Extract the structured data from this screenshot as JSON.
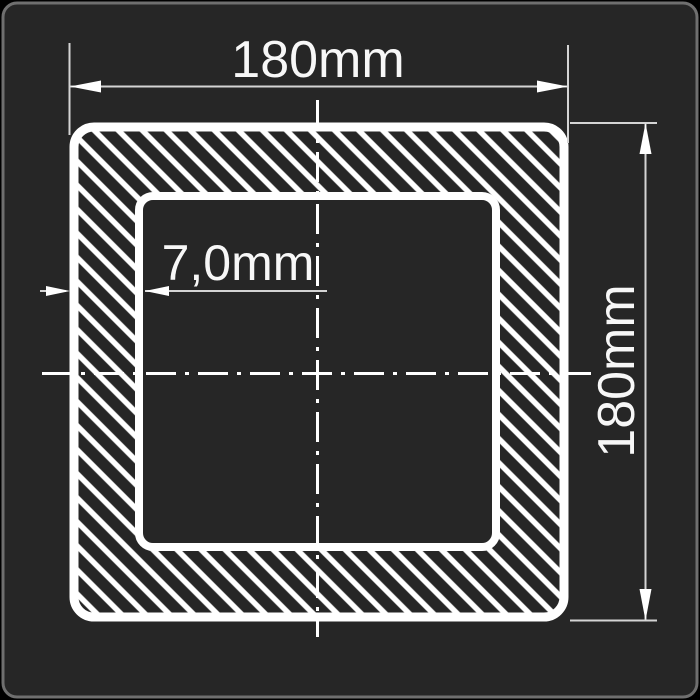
{
  "diagram": {
    "kind": "square-hollow-section-cross-section",
    "labels": {
      "width": "180mm",
      "height": "180mm",
      "wall_thickness": "7,0mm"
    }
  },
  "colors": {
    "page_bg": "#000000",
    "panel_bg": "#262626",
    "panel_border": "#6f6f6f",
    "drawing_line": "#ffffff",
    "thin_line": "#d4d4d4",
    "text": "#f7f7f7"
  }
}
